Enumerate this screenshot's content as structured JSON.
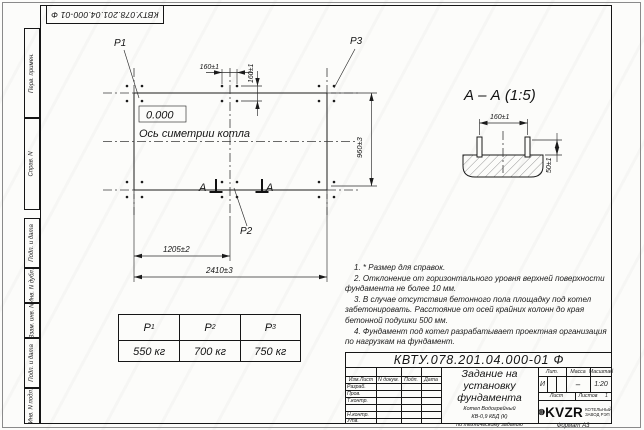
{
  "sheet": {
    "top_stamp": "КВТУ.078.201.04.000-01 Ф",
    "margin_stamps": [
      "Перв. примен.",
      "Справ. N",
      "Подп. и дата",
      "Инв. N дубл.",
      "Взам. инв. N",
      "Подп. и дата",
      "Инв. N подл."
    ],
    "format_note": "Формат А3"
  },
  "plan": {
    "p1_label": "P1",
    "p2_label": "P2",
    "p3_label": "P3",
    "elevation": "0.000",
    "axis_label": "Ось симетрии котла",
    "section_letter": "А",
    "dim_bolt_spacing_h": "160±1",
    "dim_bolt_spacing_v": "160±1",
    "dim_width": "960±3",
    "dim_half_length": "1205±2",
    "dim_full_length": "2410±3"
  },
  "section_view": {
    "title": "А – А (1:5)",
    "dim_bolt_spacing": "160±1",
    "dim_bolt_height": "50±1"
  },
  "load_table": {
    "columns": [
      {
        "name": "P",
        "sub": "1",
        "value": "550 кг"
      },
      {
        "name": "P",
        "sub": "2",
        "value": "700 кг"
      },
      {
        "name": "P",
        "sub": "3",
        "value": "750 кг"
      }
    ]
  },
  "notes": {
    "items": [
      "1. * Размер для справок.",
      "2. Отклонение от горизонтального уровня верхней поверхности фундамента не более 10 мм.",
      "3. В случае отсутствия бетонного пола площадку под котел забетонировать. Расстояние от осей крайних колонн до края бетонной подушки 500 мм.",
      "4. Фундамент под котел разрабатывает проектная организация по нагрузкам на фундамент."
    ]
  },
  "title_block": {
    "doc_number": "КВТУ.078.201.04.000-01 Ф",
    "header_cols": [
      "Изм.Лист",
      "N докум.",
      "Подп.",
      "Дата"
    ],
    "row_labels": [
      "Разраб.",
      "Пров.",
      "Т.контр.",
      "",
      "Н.контр.",
      "Утв."
    ],
    "title_lines": [
      "Задание на",
      "установку",
      "фундамента"
    ],
    "subtitle_lines": [
      "Котел Водогрейный",
      "КВ-0,9 КБД (К)",
      "по техническому заданию"
    ],
    "lit_label": "Лит.",
    "mass_label": "Масса",
    "scale_label": "Масштаб",
    "lit_value": "И",
    "mass_value": "–",
    "scale_value": "1:20",
    "sheet_label": "Лист",
    "sheets_label": "Листов",
    "sheets_value": "1",
    "logo_text": "KVZR",
    "logo_caption": [
      "КОТЕЛЬНЫЙ",
      "ЗАВОД РЭП"
    ]
  }
}
